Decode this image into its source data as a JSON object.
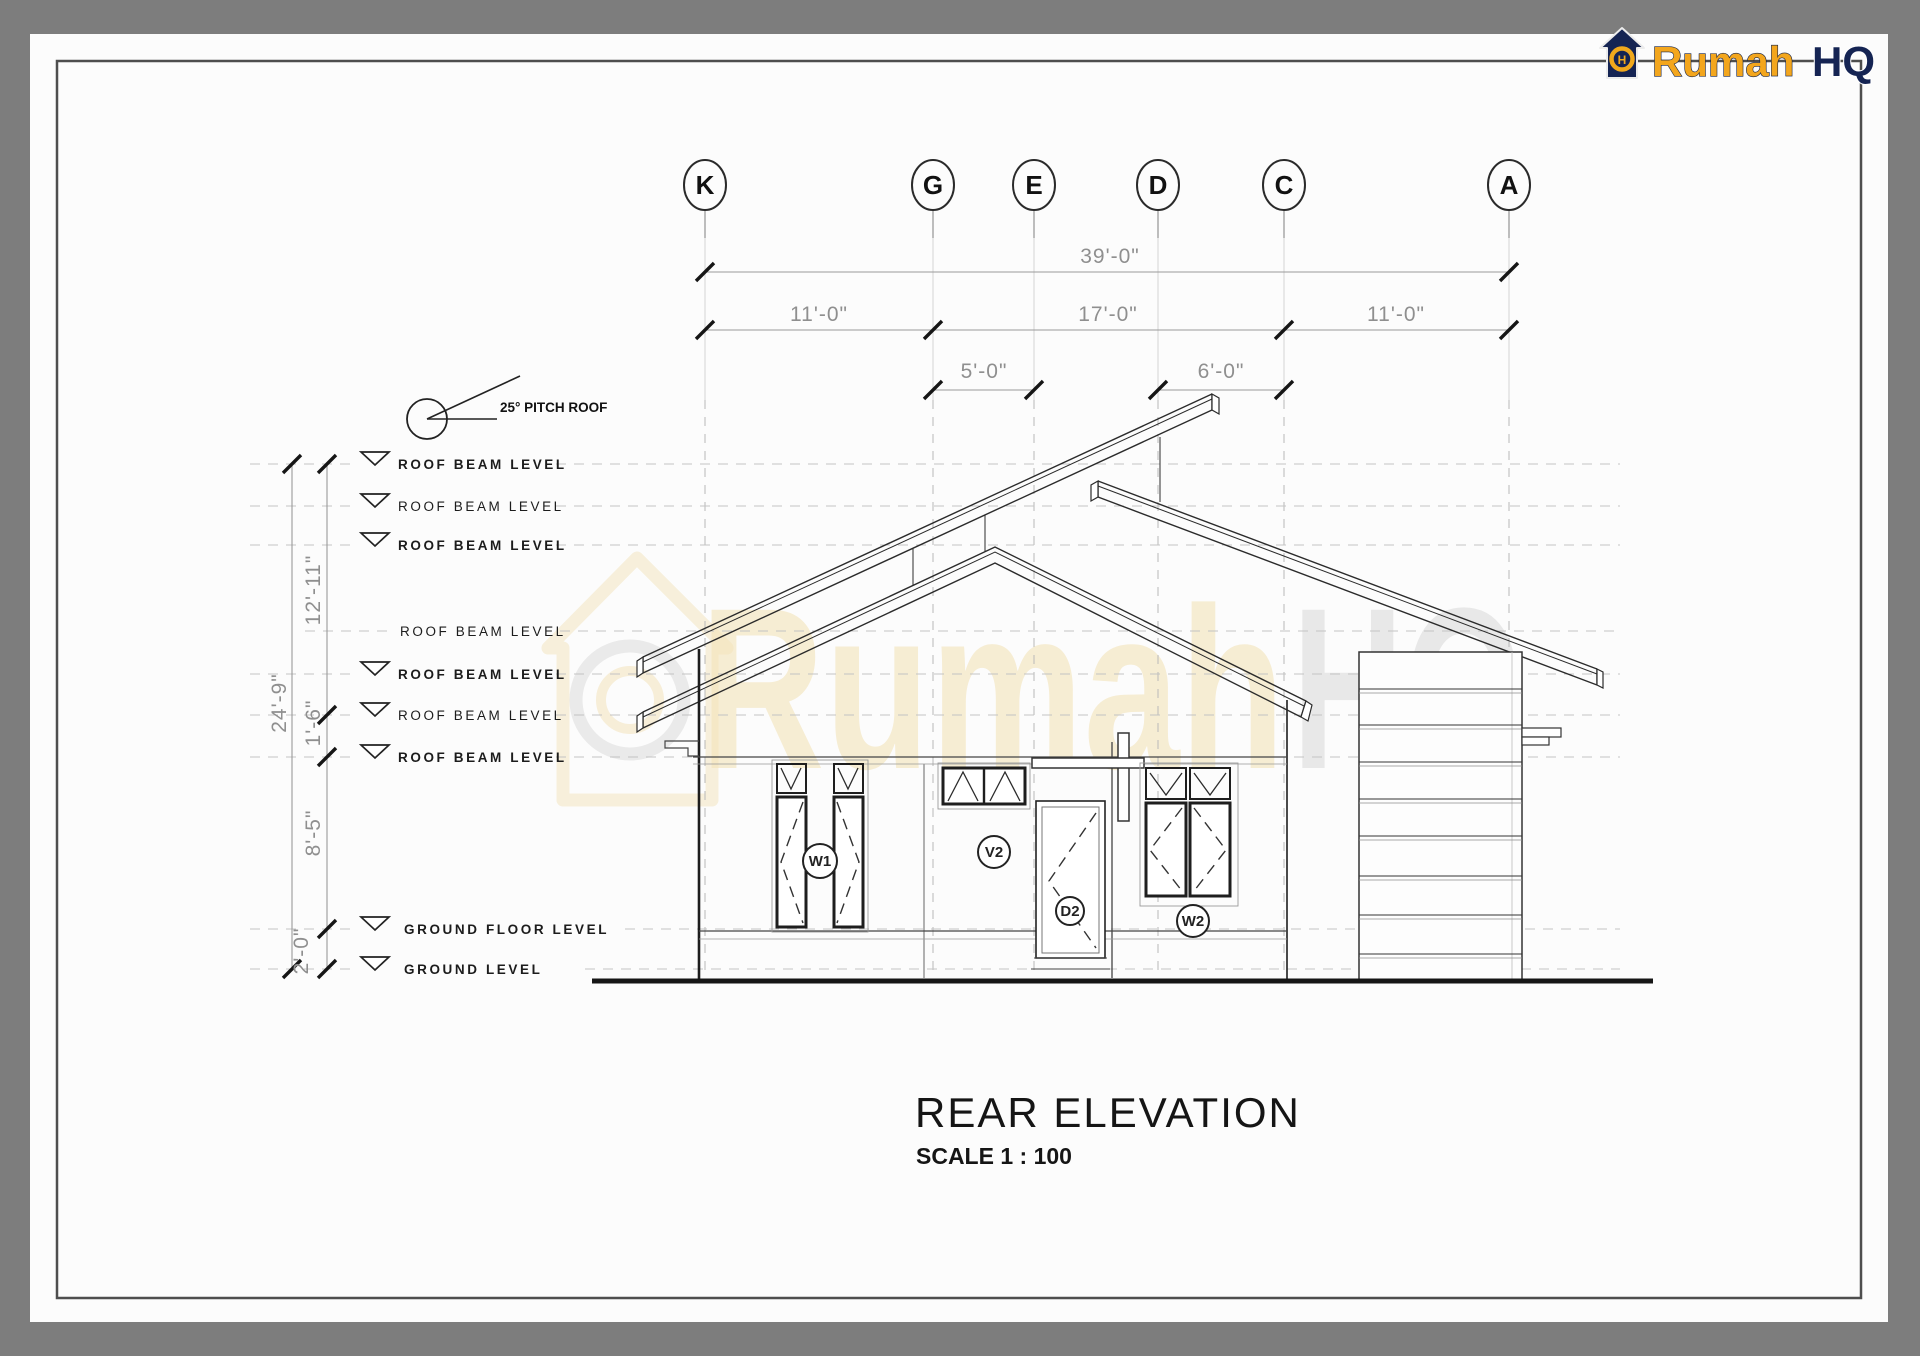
{
  "logo": {
    "word1": "Rumah",
    "word2": "HQ",
    "icon_letter": "H",
    "yellow": "#f3a61d",
    "navy": "#152453"
  },
  "grid_bubbles": [
    "K",
    "G",
    "E",
    "D",
    "C",
    "A"
  ],
  "dims": {
    "top_total": "39'-0\"",
    "top_row2": [
      "11'-0\"",
      "17'-0\"",
      "11'-0\""
    ],
    "top_row3": [
      "5'-0\"",
      "6'-0\""
    ],
    "left_total": "24'-9\"",
    "left_segments": [
      "12'-11\"",
      "1'-6\"",
      "8'-5\"",
      "2'-0\""
    ]
  },
  "levels": [
    {
      "label": "ROOF BEAM LEVEL"
    },
    {
      "label": "ROOF BEAM LEVEL"
    },
    {
      "label": "ROOF BEAM LEVEL"
    },
    {
      "label": "ROOF BEAM LEVEL"
    },
    {
      "label": "ROOF BEAM LEVEL"
    },
    {
      "label": "ROOF BEAM LEVEL"
    },
    {
      "label": "ROOF BEAM LEVEL"
    },
    {
      "label": "GROUND FLOOR LEVEL"
    },
    {
      "label": "GROUND LEVEL"
    }
  ],
  "annotations": {
    "pitch": "25° PITCH ROOF"
  },
  "tags": {
    "w1": "W1",
    "v2": "V2",
    "d2": "D2",
    "w2": "W2"
  },
  "title": {
    "name": "REAR ELEVATION",
    "scale": "SCALE 1 : 100"
  },
  "watermark": {
    "word1": "Rumah",
    "word2": "HQ"
  }
}
